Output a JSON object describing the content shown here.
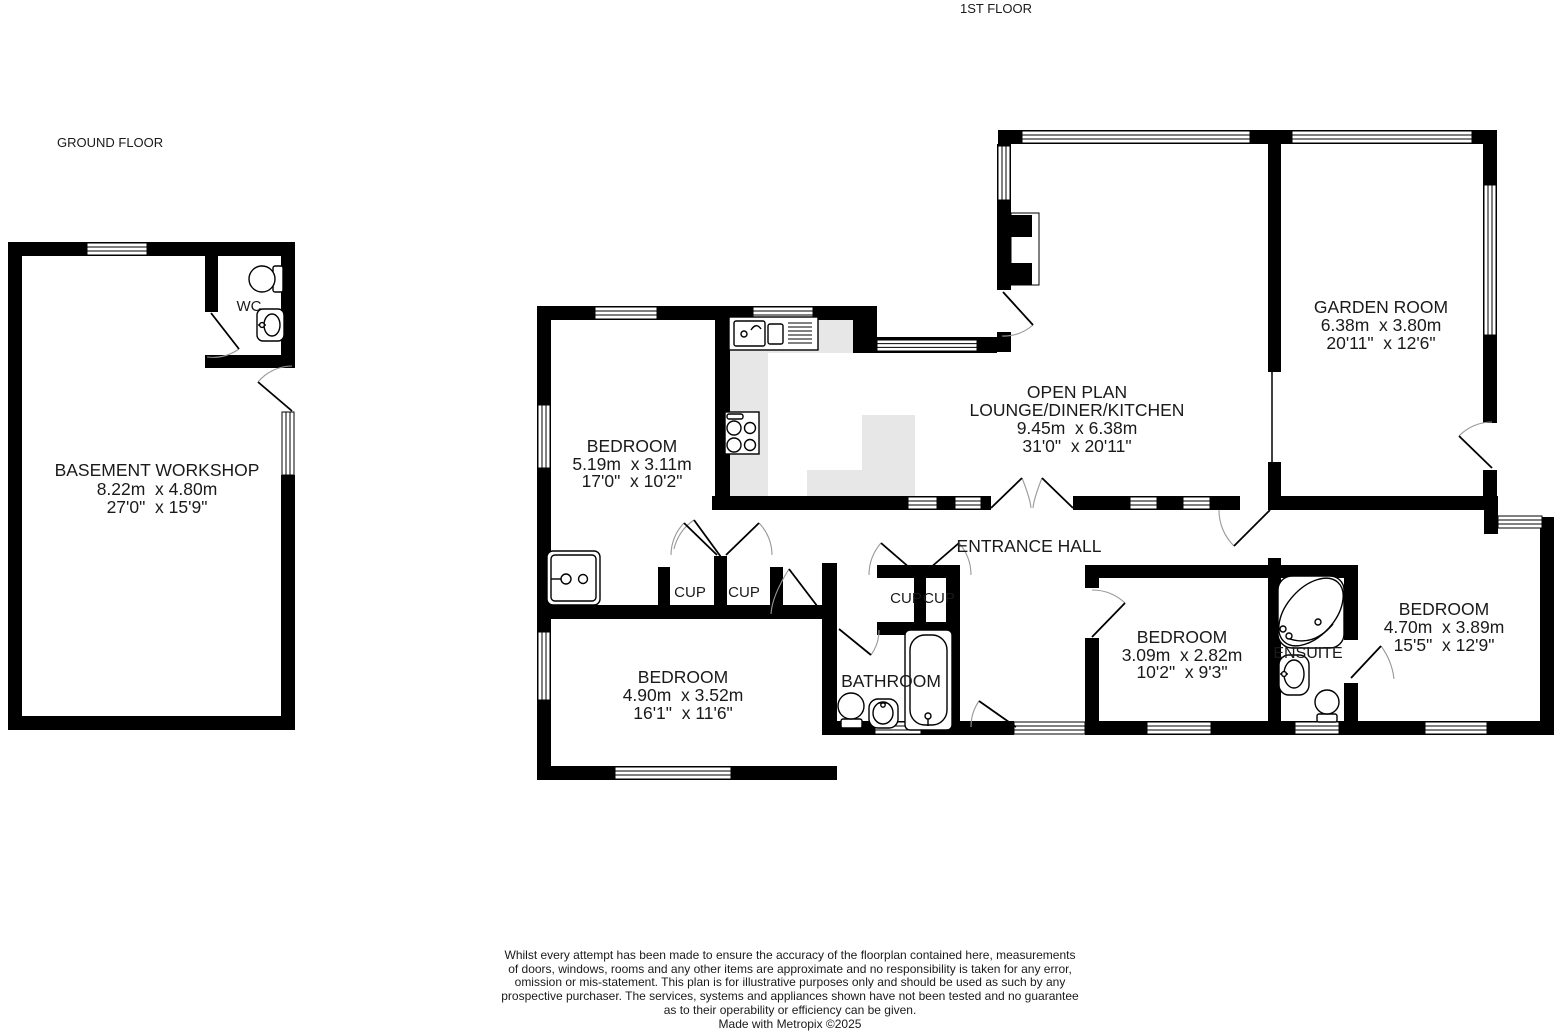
{
  "page": {
    "background": "#ffffff",
    "wall_color": "#000000",
    "counter_color": "#e7e7e7",
    "door_arc_color": "#999999"
  },
  "floor_labels": {
    "first": "1ST FLOOR",
    "ground": "GROUND FLOOR"
  },
  "rooms": {
    "basement_workshop": {
      "name": "BASEMENT WORKSHOP",
      "metric": "8.22m  x 4.80m",
      "imperial": "27'0\"  x 15'9\""
    },
    "wc": {
      "name": "WC"
    },
    "bedroom_1": {
      "name": "BEDROOM",
      "metric": "5.19m  x 3.11m",
      "imperial": "17'0\"  x 10'2\""
    },
    "open_plan": {
      "name_line1": "OPEN PLAN",
      "name_line2": "LOUNGE/DINER/KITCHEN",
      "metric": "9.45m  x 6.38m",
      "imperial": "31'0\"  x 20'11\""
    },
    "garden_room": {
      "name": "GARDEN ROOM",
      "metric": "6.38m  x 3.80m",
      "imperial": "20'11\"  x 12'6\""
    },
    "entrance_hall": {
      "name": "ENTRANCE HALL"
    },
    "bedroom_2": {
      "name": "BEDROOM",
      "metric": "4.90m  x 3.52m",
      "imperial": "16'1\"  x 11'6\""
    },
    "bathroom": {
      "name": "BATHROOM"
    },
    "bedroom_3": {
      "name": "BEDROOM",
      "metric": "3.09m  x 2.82m",
      "imperial": "10'2\"  x 9'3\""
    },
    "ensuite": {
      "name": "ENSUITE"
    },
    "bedroom_4": {
      "name": "BEDROOM",
      "metric": "4.70m  x 3.89m",
      "imperial": "15'5\"  x 12'9\""
    },
    "cupboard": {
      "name": "CUP"
    }
  },
  "disclaimer": {
    "line1": "Whilst every attempt has been made to ensure the accuracy of the floorplan contained here, measurements",
    "line2": "of doors, windows, rooms and any other items are approximate and no responsibility is taken for any error,",
    "line3": "omission or mis-statement. This plan is for illustrative purposes only and should be used as such by any",
    "line4": "prospective purchaser. The services, systems and appliances shown have not been tested and no guarantee",
    "line5": "as to their operability or efficiency can be given.",
    "credit": "Made with Metropix ©2025"
  }
}
